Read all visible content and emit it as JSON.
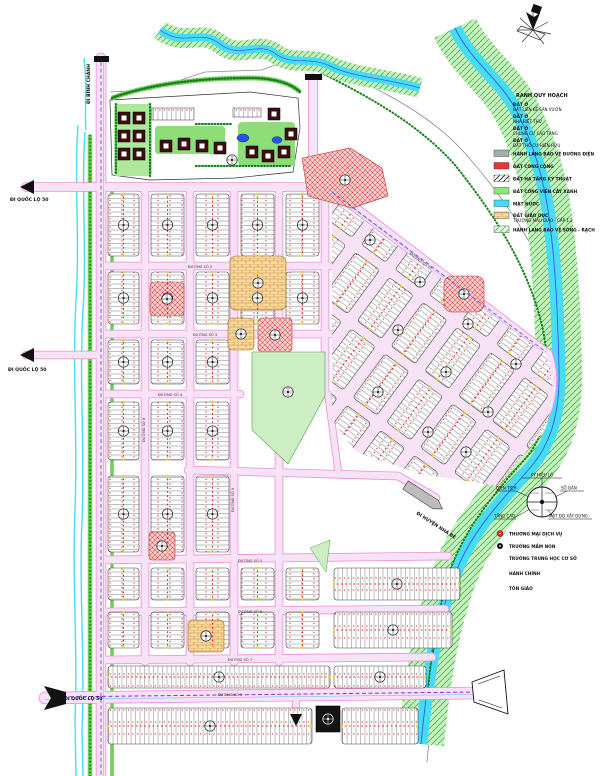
{
  "map": {
    "labels": {
      "to_ql50_a": "ĐI QUỐC LỘ 50",
      "to_ql50_b": "ĐI QUỐC LỘ 50",
      "to_ql50_c": "ĐI QUỐC LỘ 50",
      "to_binh_chanh": "ĐI BÌNH CHÁNH",
      "to_nha_be": "ĐI HUYỆN NHÀ BÈ"
    },
    "road_names": [
      "ĐƯỜNG SỐ 1",
      "ĐƯỜNG SỐ 2",
      "ĐƯỜNG SỐ 3",
      "ĐƯỜNG SỐ 4",
      "ĐƯỜNG SỐ 5",
      "ĐƯỜNG SỐ 6",
      "ĐƯỜNG SỐ 7",
      "ĐƯỜNG SỐ 8",
      "ĐƯỜNG SỐ 9",
      "ĐƯỜNG SỐ 10"
    ]
  },
  "legend_landuse": {
    "title": "RANH QUY HOẠCH",
    "residential_items": [
      {
        "line1": "ĐẤT Ở",
        "line2": "ĐẤT LIÊN KẾ SÂN VƯỜN"
      },
      {
        "line1": "ĐẤT Ở",
        "line2": "NHÀ BIỆT THỰ"
      },
      {
        "line1": "ĐẤT Ở",
        "line2": "CHUNG CƯ CAO TẦNG"
      },
      {
        "line1": "ĐẤT Ở",
        "line2": "ĐẤT THỔ CƯ HIỆN HỮU"
      }
    ],
    "swatch_items": [
      {
        "label": "HÀNH LANG BẢO VỆ ĐƯỜNG ĐIỆN",
        "color": "#9fb0b0"
      },
      {
        "label": "ĐẤT CÔNG CỘNG",
        "color": "#ee3333"
      },
      {
        "label": "ĐẤT HẠ TẦNG KỸ THUẬT",
        "color": "#222222"
      },
      {
        "label": "ĐẤT CÔNG VIÊN CÂY XANH",
        "color": "#8de87c"
      },
      {
        "label": "MẶT NƯỚC",
        "color": "#3fe0f8"
      },
      {
        "label": "ĐẤT GIÁO DỤC",
        "label2": "TRƯỜNG MẪU GIÁO - CẤP 1,2",
        "color": "#f2b84a"
      },
      {
        "label": "HÀNH LANG BẢO VỆ SÔNG - RẠCH",
        "color": "#4cc84c"
      }
    ]
  },
  "legend_symbols": {
    "lot_circle": {
      "top": "KÝ HIỆU LÔ",
      "left": "DIỆN TÍCH",
      "right": "SỐ DÂN",
      "bottom_left": "TẦNG CAO",
      "bottom_right": "MẬT ĐỘ XÂY DỰNG"
    },
    "point_items": [
      {
        "label": "THƯƠNG MẠI DỊCH VỤ",
        "icon": "red-circle-icon"
      },
      {
        "label": "TRƯỜNG MẦM NON",
        "icon": "black-circle-icon"
      },
      {
        "label": "TRƯỜNG TRUNG HỌC CƠ SỞ",
        "icon": "none"
      },
      {
        "label": "HÀNH CHÍNH",
        "icon": "none"
      },
      {
        "label": "TÔN GIÁO",
        "icon": "none"
      }
    ]
  },
  "colors": {
    "road_fill": "#f8e3f6",
    "road_edge": "#ee8ade",
    "water": "#45ddf5",
    "water_line": "#3a55ee",
    "corridor": "#c9eec2",
    "park": "#cdeec4",
    "public_red": "#ee3333",
    "education_orange": "#f2b84a",
    "power_dash": "#8a2be2",
    "boundary_gray": "#8a8a8a"
  }
}
